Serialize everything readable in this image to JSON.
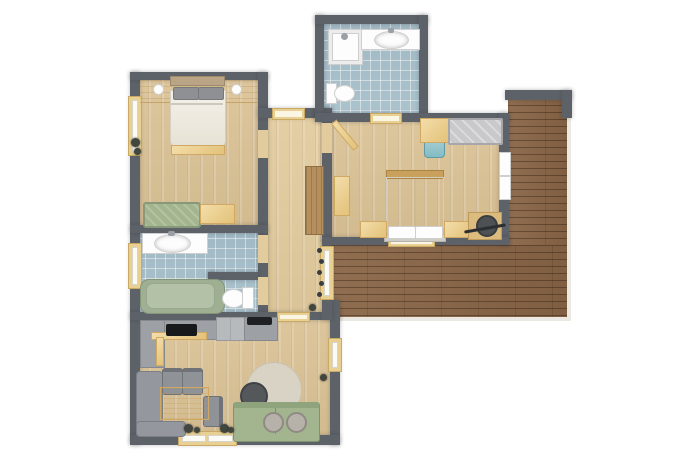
{
  "meta": {
    "title": "Apartment Floor Plan",
    "view": "top-down 2D architectural render",
    "canvas": {
      "width": 700,
      "height": 467
    },
    "visible_text": "none"
  },
  "palette": {
    "background": "#ffffff",
    "wall": "#5d6269",
    "wood_floor": "#dbc295",
    "hall_floor": "#e2cb9d",
    "tile_floor": "#a7c0cb",
    "terrace_deck": "#8a6647",
    "terrace_edge": "#ece9e2",
    "furniture_wood": "#ecd096",
    "wood_dark": "#b5905d",
    "sage_green": "#a3b58e",
    "gray_upholstery": "#94989e",
    "light_gray_bench": "#c9c9cb",
    "white_fixture": "#fdfdfd",
    "window_frame": "#e8d092",
    "teal_chair": "#84bcc4",
    "charcoal": "#2a2d30",
    "bedding": "#efece3",
    "pillow_gray": "#8e9094",
    "rug": "#d9d3c5"
  },
  "rooms": [
    {
      "id": "bedroom-1",
      "label": "bedroom top-left",
      "floor": "light wood planks"
    },
    {
      "id": "bathroom-1",
      "label": "bathroom with tub",
      "floor": "blue tile"
    },
    {
      "id": "wc",
      "label": "separate toilet room",
      "floor": "blue tile"
    },
    {
      "id": "hallway",
      "label": "entry hallway",
      "floor": "light wood planks"
    },
    {
      "id": "living-kitchen",
      "label": "living room with kitchen",
      "floor": "light wood planks"
    },
    {
      "id": "bedroom-2",
      "label": "bedroom right",
      "floor": "light wood planks"
    },
    {
      "id": "bathroom-2",
      "label": "ensuite shower bathroom",
      "floor": "blue tile"
    },
    {
      "id": "terrace",
      "label": "L-shaped wooden terrace",
      "floor": "dark wood deck"
    }
  ],
  "furniture": {
    "bedroom_1": [
      "double-bed with gray pillows",
      "headboard shelf with two wall lamps",
      "foot bench",
      "sage sofa-bench",
      "wooden chest",
      "window with plant"
    ],
    "bathroom_1": [
      "white vanity with oval sink",
      "sage green bathtub",
      "toilet",
      "window"
    ],
    "hallway": [
      "dark wood wardrobe",
      "coat hooks",
      "entry door",
      "door to bedroom 2",
      "window to terrace"
    ],
    "living_kitchen": [
      "L-shaped kitchen counter",
      "black cooktop",
      "sink unit",
      "tall cabinet",
      "gray corner bench",
      "wooden dining table",
      "three gray chairs",
      "round rug",
      "dark round coffee table",
      "sage sofa with two round trays",
      "window with plants"
    ],
    "bedroom_2": [
      "double-bed with white pillows",
      "two nightstands",
      "desk with teal chair",
      "gray tufted daybed",
      "wood cabinet",
      "corner vanity desk with stool",
      "french doors to terrace",
      "terrace door"
    ],
    "bathroom_2": [
      "corner shower",
      "white vanity with oval sink",
      "toilet"
    ],
    "terrace": [
      "horizontal deck boards"
    ]
  }
}
